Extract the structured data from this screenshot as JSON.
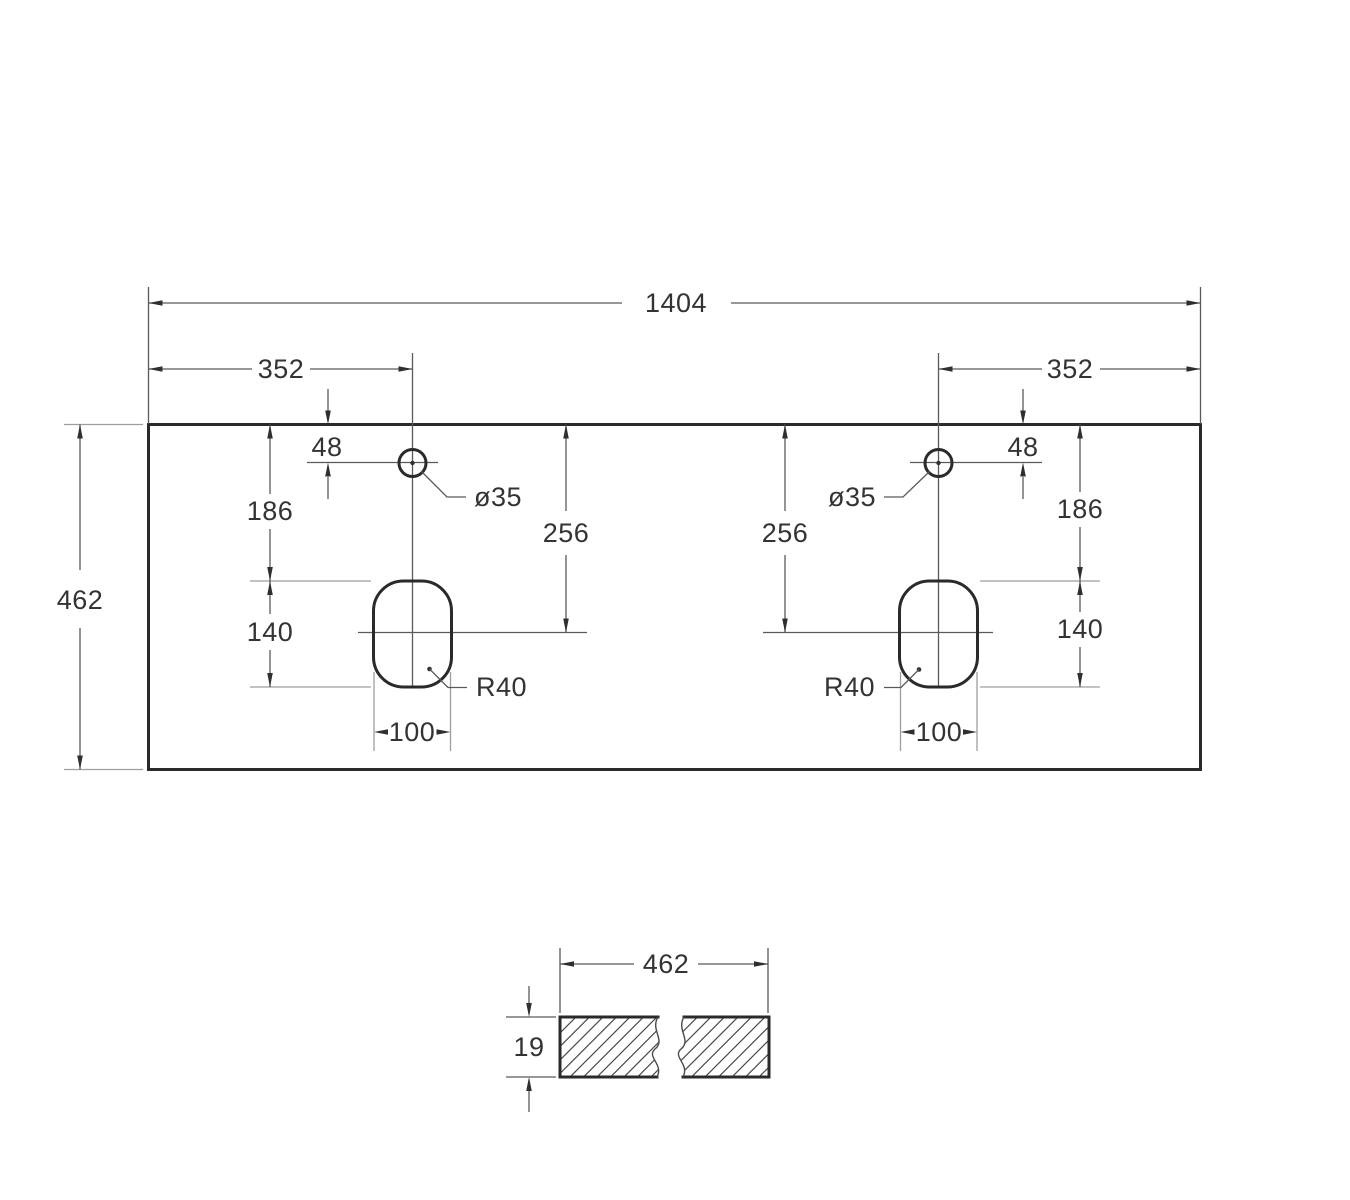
{
  "colors": {
    "background": "#ffffff",
    "outline": "#2a2a2a",
    "dimension_line": "#5a5a5a",
    "extension_line": "#9e9e9e",
    "text": "#333333"
  },
  "top_view": {
    "dims": {
      "overall_width": "1404",
      "depth": "462",
      "faucet_offset_left": "352",
      "faucet_offset_right": "352",
      "faucet_setback_left": "48",
      "faucet_setback_right": "48",
      "faucet_hole_diameter_left": "ø35",
      "faucet_hole_diameter_right": "ø35",
      "edge_to_cutout_left": "186",
      "edge_to_cutout_right": "186",
      "edge_to_cutout_center_left": "256",
      "edge_to_cutout_center_right": "256",
      "cutout_length_left": "140",
      "cutout_length_right": "140",
      "cutout_width_left": "100",
      "cutout_width_right": "100",
      "cutout_corner_radius_left": "R40",
      "cutout_corner_radius_right": "R40"
    }
  },
  "section_view": {
    "dims": {
      "width": "462",
      "thickness": "19"
    }
  }
}
